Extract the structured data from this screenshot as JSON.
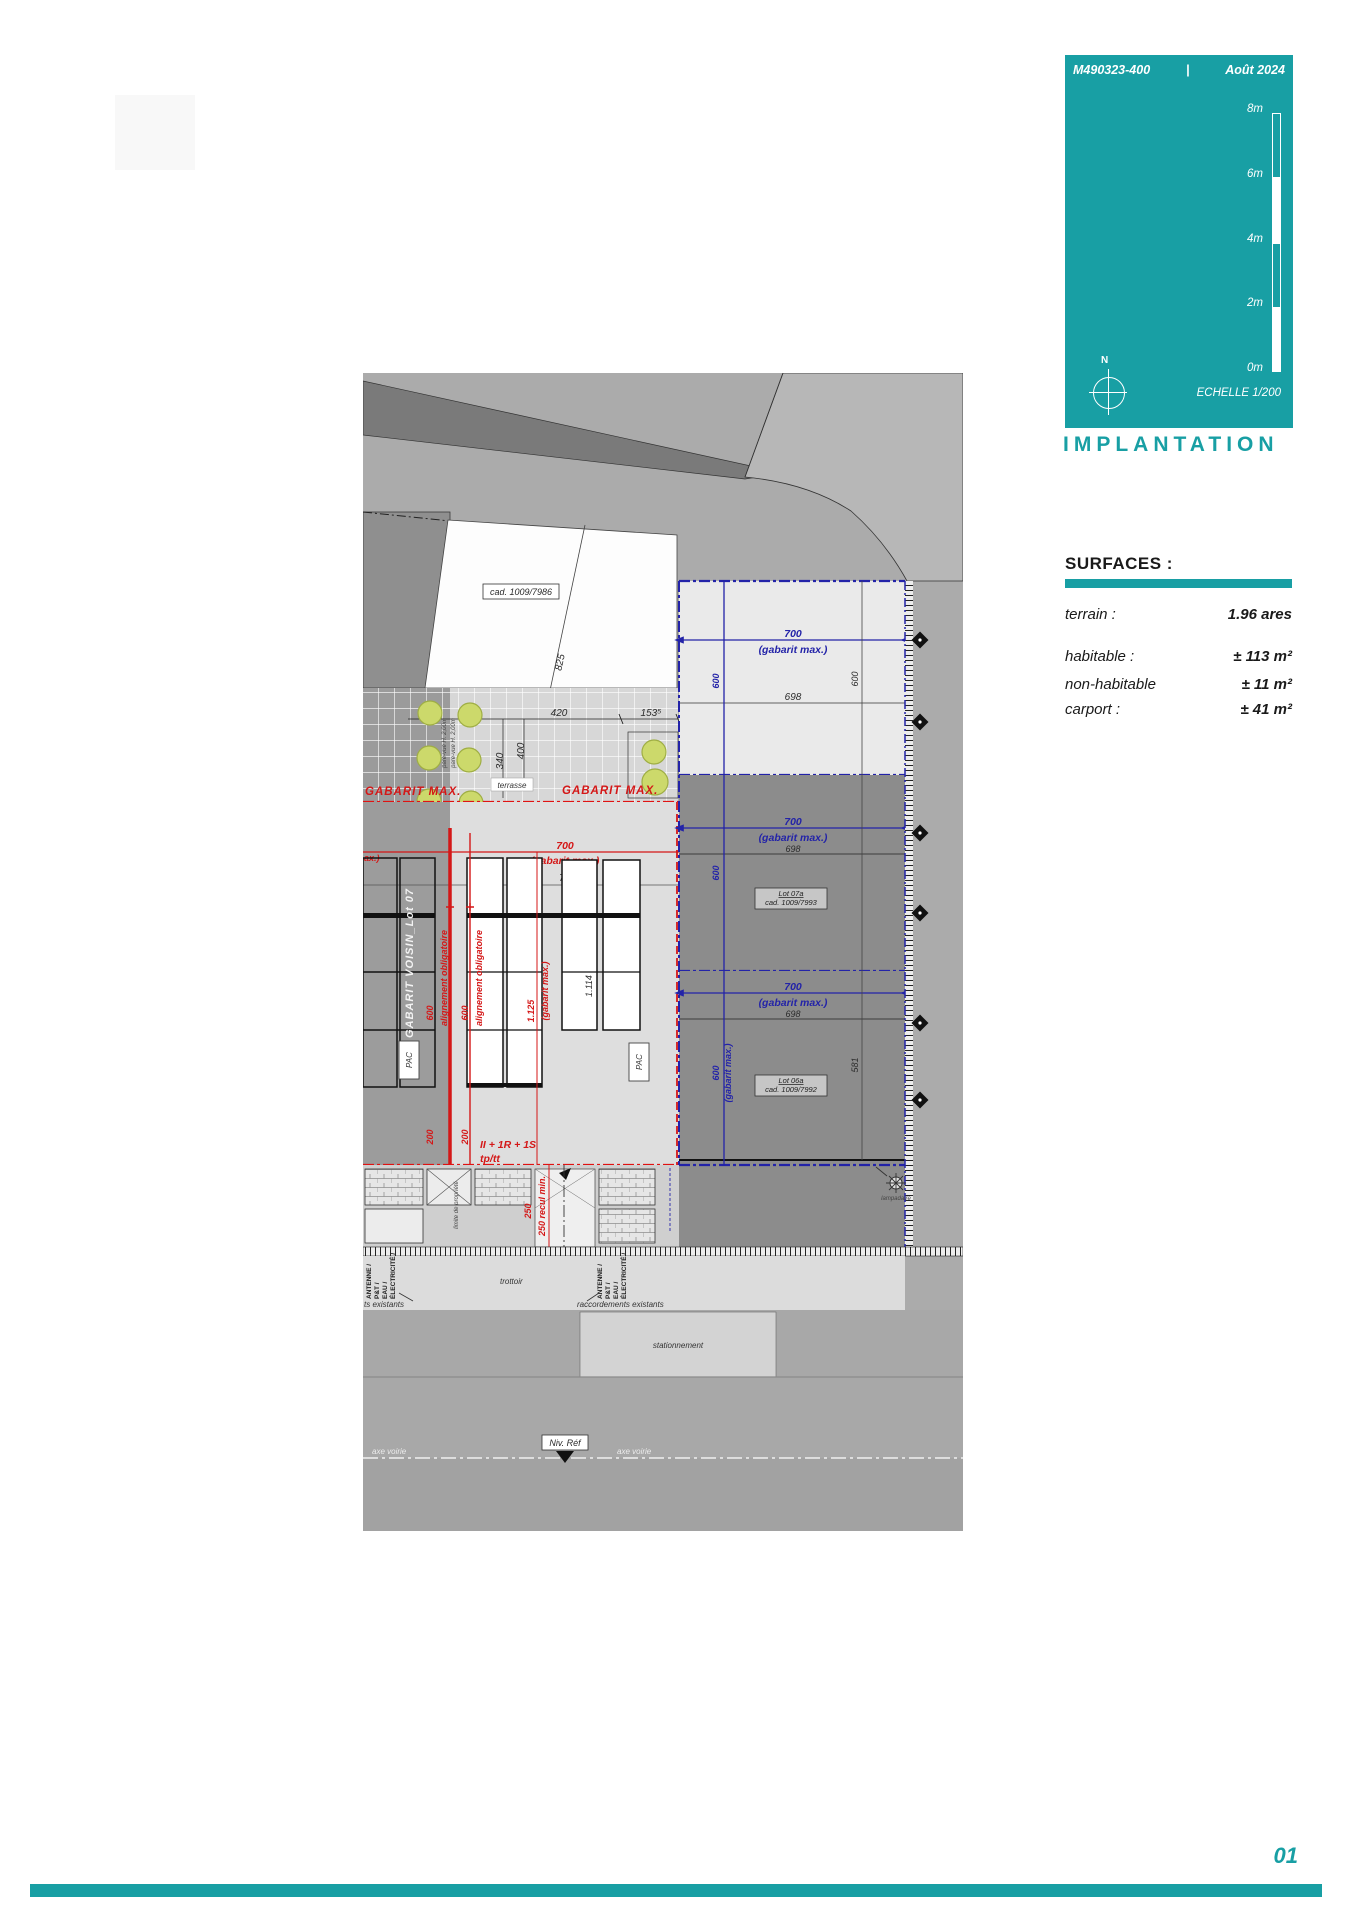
{
  "meta": {
    "ref": "M490323-400",
    "divider": "|",
    "date": "Août 2024"
  },
  "scalebar": {
    "labels": [
      "8m",
      "6m",
      "4m",
      "2m",
      "0m"
    ],
    "echelle": "ECHELLE  1/200",
    "north": "N"
  },
  "title": "IMPLANTATION",
  "surfaces": {
    "heading": "SURFACES :",
    "rows": [
      {
        "label": "terrain :",
        "value": "1.96 ares"
      },
      {
        "label": "habitable :",
        "value": "± 113 m²"
      },
      {
        "label": "non-habitable",
        "value": "± 11 m²"
      },
      {
        "label": "carport :",
        "value": "± 41 m²"
      }
    ]
  },
  "page": {
    "number": "01"
  },
  "plan": {
    "cad_main": "cad. 1009/7986",
    "d825": "825",
    "d420": "420",
    "d153": "153⁵",
    "d340": "340",
    "d400": "400",
    "pare_vue": "pare-vue H. 2,00m",
    "terrasse": "terrasse",
    "gabarit_max": "GABARIT MAX.",
    "left_clip": "ax.)",
    "d700": "700",
    "gabarit_paren": "(gabarit max.)",
    "d698": "698",
    "d600": "600",
    "d581": "581",
    "d200": "200",
    "d250": "250",
    "d1125": "1.125",
    "d1114": "1.114",
    "gabarit_voisin": "GABARIT VOISIN_Lot 07",
    "alignement": "alignement obligatoire",
    "recul": "250 recul min.",
    "floors": "II + 1R + 1S",
    "fptt": "tp/tt",
    "pac": "PAC",
    "limite": "limite de propriété",
    "axe_maison": "axe maison",
    "lot07a": {
      "name": "Lot 07a",
      "cad": "cad. 1009/7993"
    },
    "lot06a": {
      "name": "Lot 06a",
      "cad": "cad. 1009/7992"
    },
    "lampadaire": "lampadaire",
    "utilities": [
      "ANTENNE /",
      "P&T /",
      "EAU /",
      "ÉLECTRICITÉ /"
    ],
    "racc_left": "ts existants",
    "racc_right": "raccordements existants",
    "trottoir": "trottoir",
    "stationnement": "stationnement",
    "axe_voirie": "axe voirie",
    "niv_ref": "Niv. Réf"
  },
  "colors": {
    "teal": "#189fa4",
    "red": "#d41717",
    "blue": "#2323a8",
    "tree": "#ccd96b"
  }
}
